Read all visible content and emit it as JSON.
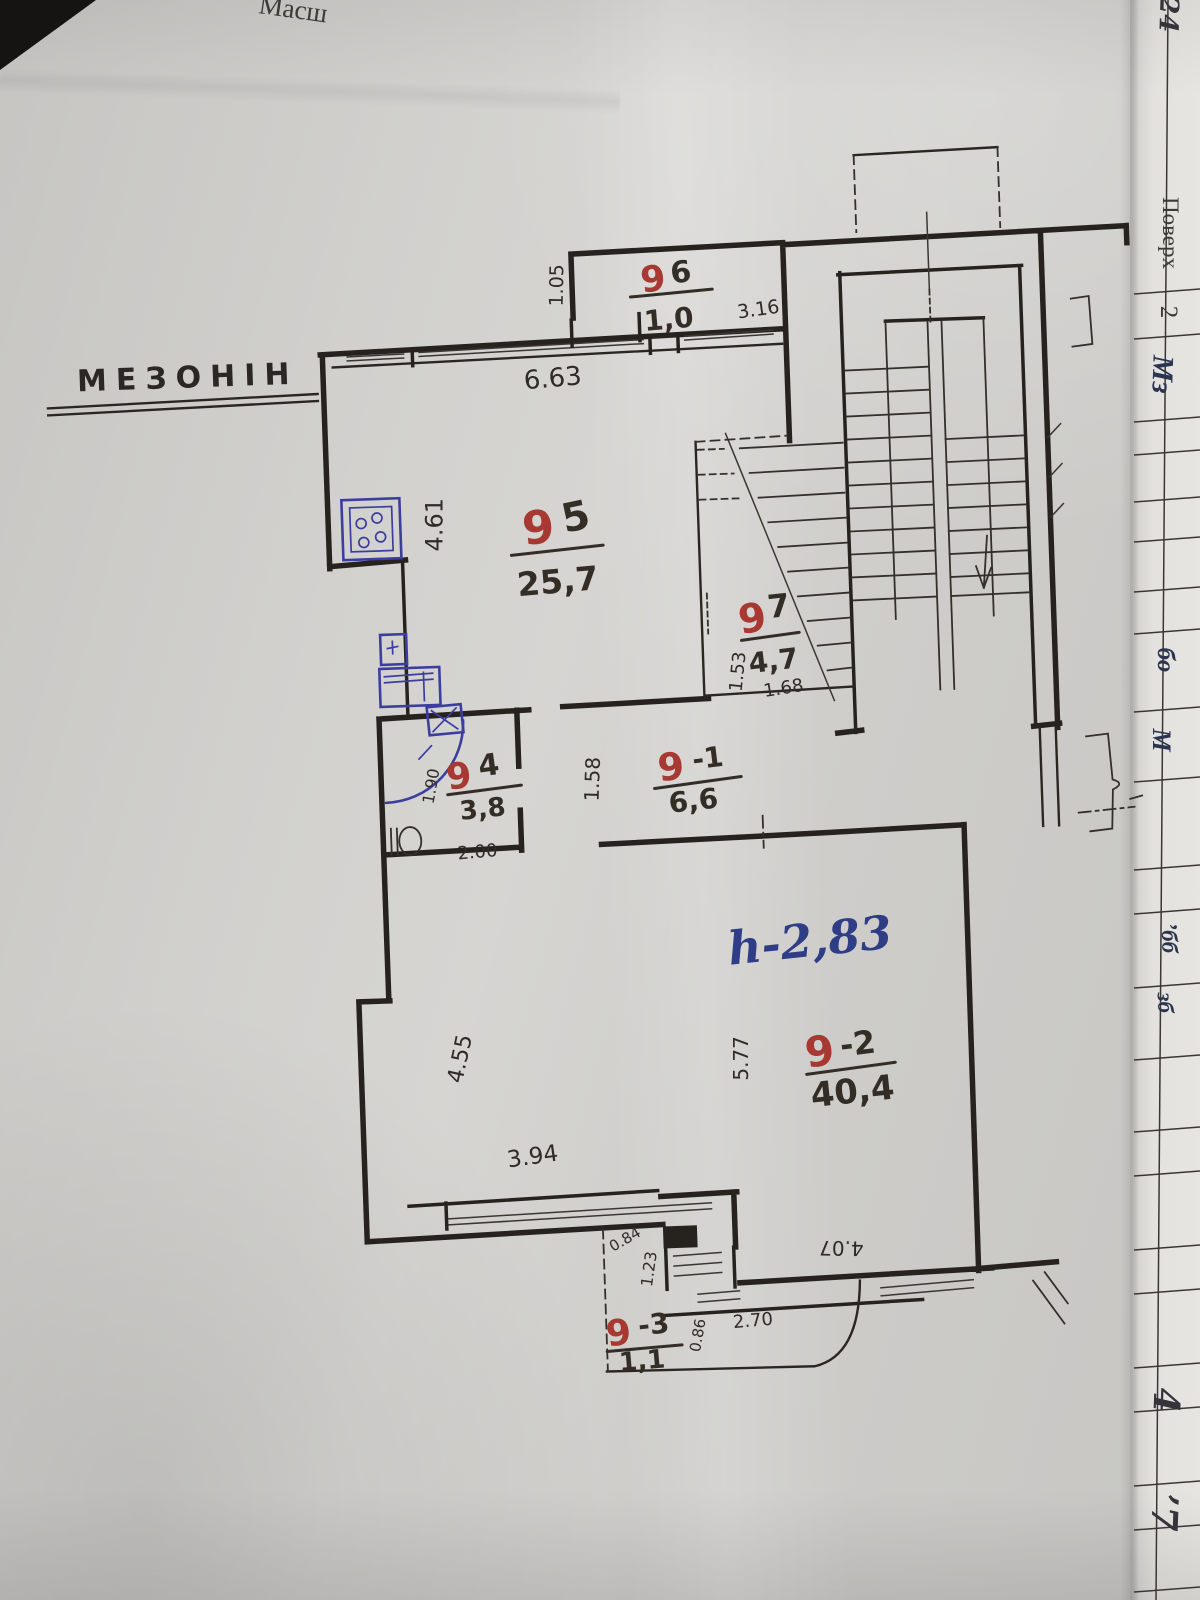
{
  "page": {
    "top_edge_text": "Масш",
    "plan_title": "МЕЗОНІН",
    "height_note": "h-2,83"
  },
  "rooms": [
    {
      "id": "9-6",
      "red": "9",
      "suffix": "6",
      "area": "1,0"
    },
    {
      "id": "9-5",
      "red": "9",
      "suffix": "5",
      "area": "25,7"
    },
    {
      "id": "9-7",
      "red": "9",
      "suffix": "7",
      "area": "4,7"
    },
    {
      "id": "9-4",
      "red": "9",
      "suffix": "4",
      "area": "3,8"
    },
    {
      "id": "9-1",
      "red": "9",
      "suffix": "-1",
      "area": "6,6"
    },
    {
      "id": "9-2",
      "red": "9",
      "suffix": "-2",
      "area": "40,4"
    },
    {
      "id": "9-3",
      "red": "9",
      "suffix": "-3",
      "area": "1,1"
    }
  ],
  "dims": {
    "w105": "1.05",
    "w663": "6.63",
    "w316": "3.16",
    "w461": "4.61",
    "w153": "1.53",
    "w168": "1.68",
    "w190": "1.90",
    "w200": "2.00",
    "w158": "1.58",
    "w455": "4.55",
    "w577": "5.77",
    "w394": "3.94",
    "w084": "0.84",
    "w123": "1.23",
    "w086": "0.86",
    "w270": "2.70",
    "w407": "4.07"
  },
  "margin": {
    "header": "Поверх",
    "floor": "2",
    "corner_fragment": "24",
    "entries": [
      "Мз",
      "бо",
      "М",
      "’бб",
      "зб",
      "4",
      "’7"
    ]
  },
  "colors": {
    "ink": "#26231f",
    "room_number_red": "#a83832",
    "fixture_blue": "#3b3e9e",
    "pen_blue": "#2e3d85",
    "paper": "#cfcecb"
  }
}
